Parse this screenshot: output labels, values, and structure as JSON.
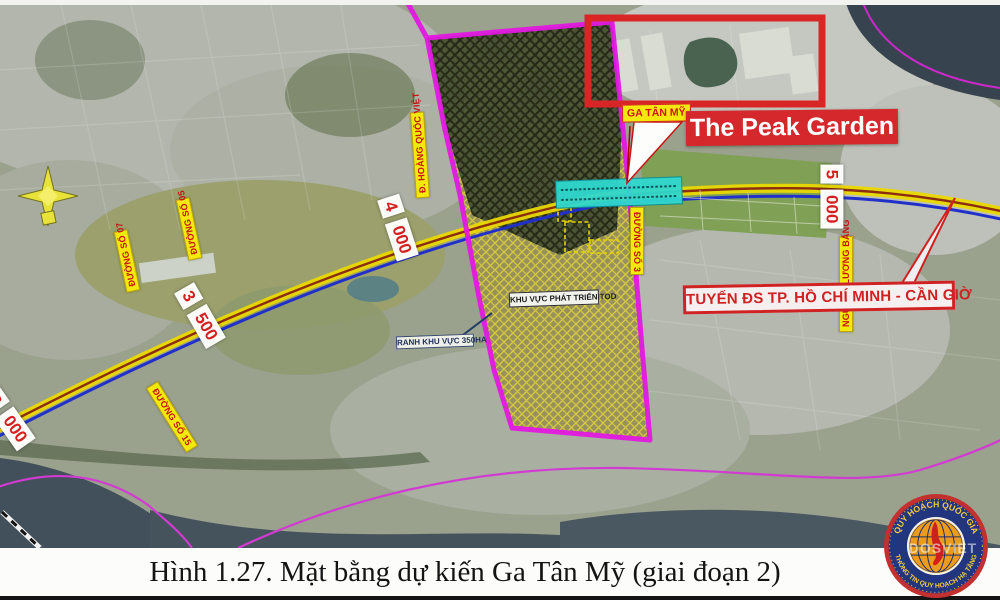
{
  "caption": "Hình 1.27. Mặt bằng dự kiến Ga Tân Mỹ (giai đoạn 2)",
  "labels": {
    "station": "GA TÂN MỸ",
    "peak_garden": "The Peak Garden",
    "rail_line": "TUYẾN ĐS TP. HỒ CHÍ MINH - CẦN GIỜ",
    "tod_area": "KHU VỰC PHÁT TRIỂN TOD",
    "area_boundary": "RANH KHU VỰC 350HA"
  },
  "streets": [
    {
      "name": "Đ. HOÀNG QUỐC VIỆT"
    },
    {
      "name": "ĐƯỜNG SỐ 07"
    },
    {
      "name": "ĐƯỜNG SỐ 05"
    },
    {
      "name": "ĐƯỜNG SỐ 15"
    },
    {
      "name": "ĐƯỜNG SỐ 3"
    },
    {
      "name": "NGUYỄN LƯƠNG BẰNG"
    }
  ],
  "km_markers": [
    {
      "km": "3",
      "meter": "000"
    },
    {
      "km": "3",
      "meter": "500"
    },
    {
      "km": "4",
      "meter": "000"
    },
    {
      "km": "5",
      "meter": "000"
    }
  ],
  "logo": {
    "top_text": "QUY HOẠCH QUỐC GIA",
    "bottom_text": "THÔNG TIN QUY HOẠCH HẠ TẦNG",
    "watermark": "DOSVIET"
  },
  "colors": {
    "boundary_magenta": "#e219e2",
    "station_cyan": "#2fd8cf",
    "accent_red": "#d4282c",
    "label_yellow": "#f4e80c",
    "rail_yellow": "#ead800",
    "rail_blue": "#2130c8"
  }
}
